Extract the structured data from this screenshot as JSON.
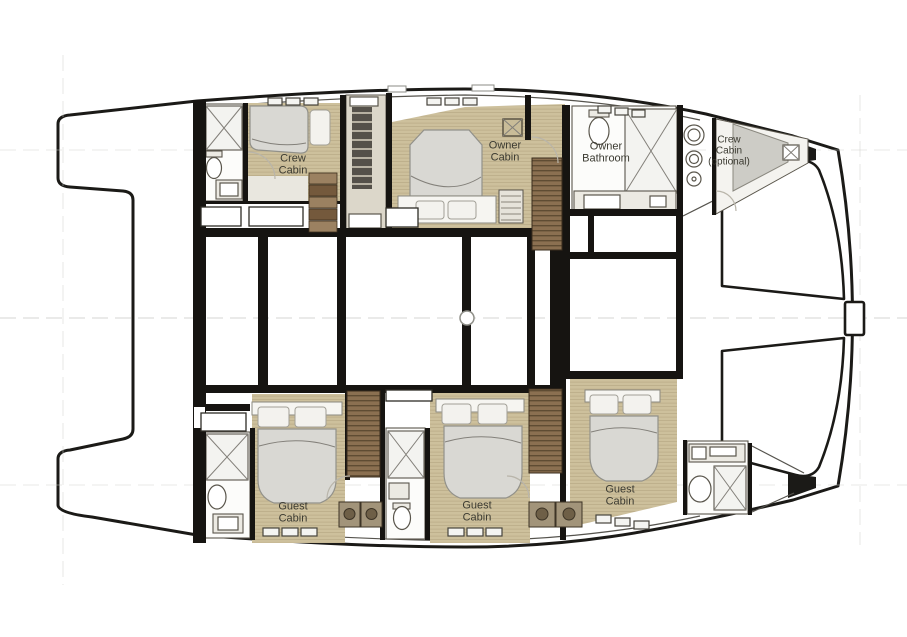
{
  "diagram": {
    "type": "yacht-deck-floorplan",
    "vessel": "catamaran",
    "labels": {
      "crew_cabin_aft": {
        "lines": [
          "Crew",
          "Cabin"
        ]
      },
      "owner_cabin": {
        "lines": [
          "Owner",
          "Cabin"
        ]
      },
      "owner_bathroom": {
        "lines": [
          "Owner",
          "Bathroom"
        ]
      },
      "crew_cabin_fwd": {
        "lines": [
          "Crew",
          "Cabin",
          "(optional)"
        ]
      },
      "guest_cabin_aft": {
        "lines": [
          "Guest",
          "Cabin"
        ]
      },
      "guest_cabin_mid": {
        "lines": [
          "Guest",
          "Cabin"
        ]
      },
      "guest_cabin_fwd": {
        "lines": [
          "Guest",
          "Cabin"
        ]
      }
    },
    "colors": {
      "background": "#ffffff",
      "wall": "#161411",
      "hull_outline": "#1b1a17",
      "wood_floor": "#cdc09c",
      "wood_plank_line": "#a3946e",
      "stair_wood": "#8b7051",
      "stair_tread": "#5f4c33",
      "bed_mattress": "#d9d8d3",
      "pillow": "#f3f2ee",
      "bathroom_floor": "#fcfcfa",
      "fixture_outline": "#5a564c",
      "berth_shade": "#cdccc6",
      "appliance": "#a2947a",
      "guide_line": "#cfcfcb",
      "label_text": "#3b3a31"
    }
  }
}
